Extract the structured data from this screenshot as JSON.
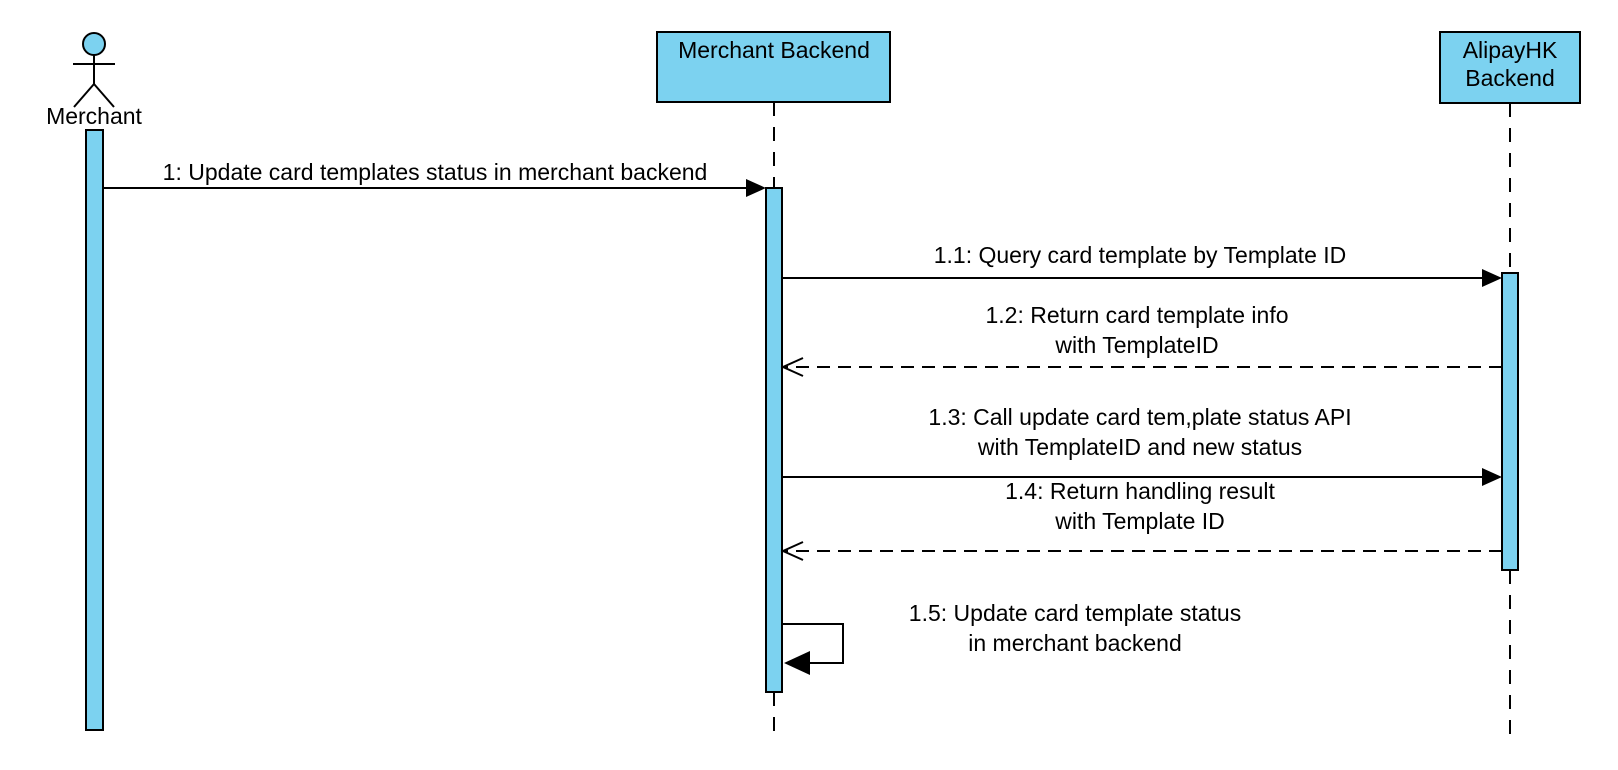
{
  "colors": {
    "participant_fill": "#7cd2f0",
    "line": "#000000",
    "background": "#ffffff"
  },
  "actor": {
    "label": "Merchant"
  },
  "participants": [
    {
      "name": "Merchant Backend",
      "lines": [
        "Merchant Backend"
      ]
    },
    {
      "name": "AlipayHK Backend",
      "lines": [
        "AlipayHK",
        "Backend"
      ]
    }
  ],
  "messages": [
    {
      "seq": "1",
      "from": "Merchant",
      "to": "Merchant Backend",
      "type": "solid",
      "lines": [
        "1: Update card templates status in merchant backend"
      ]
    },
    {
      "seq": "1.1",
      "from": "Merchant Backend",
      "to": "AlipayHK Backend",
      "type": "solid",
      "lines": [
        "1.1: Query card template by Template ID"
      ]
    },
    {
      "seq": "1.2",
      "from": "AlipayHK Backend",
      "to": "Merchant Backend",
      "type": "dashed-return",
      "lines": [
        "1.2: Return card template info",
        "with TemplateID"
      ]
    },
    {
      "seq": "1.3",
      "from": "Merchant Backend",
      "to": "AlipayHK Backend",
      "type": "solid",
      "lines": [
        "1.3: Call update card tem,plate status API",
        "with TemplateID and new status"
      ]
    },
    {
      "seq": "1.4",
      "from": "AlipayHK Backend",
      "to": "Merchant Backend",
      "type": "dashed-return",
      "lines": [
        "1.4: Return handling result",
        "with Template ID"
      ]
    },
    {
      "seq": "1.5",
      "from": "Merchant Backend",
      "to": "Merchant Backend",
      "type": "self",
      "lines": [
        "1.5: Update card template status",
        "in merchant backend"
      ]
    }
  ]
}
